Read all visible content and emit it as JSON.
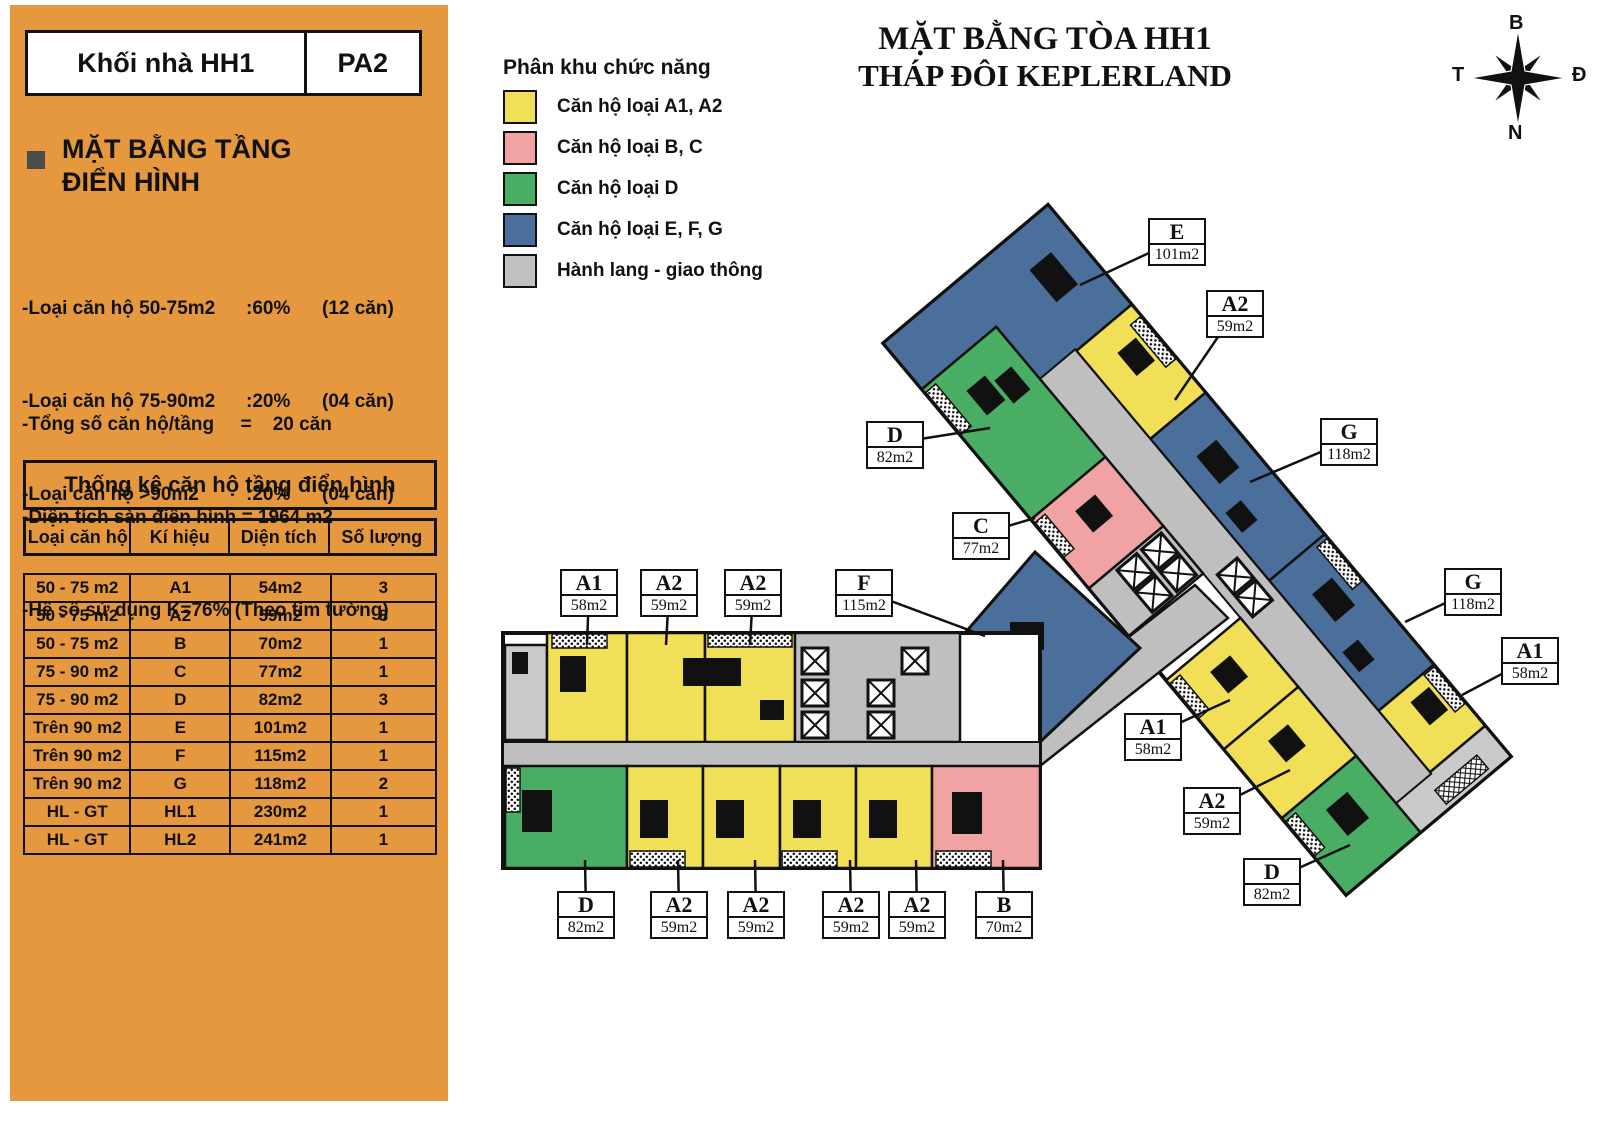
{
  "sidebar": {
    "header": {
      "left": "Khối nhà HH1",
      "right": "PA2"
    },
    "section_title_line1": "MẶT BẰNG TẦNG",
    "section_title_line2": "ĐIỂN HÌNH",
    "stats1": [
      {
        "label": "-Loại căn hộ 50-75m2",
        "pct": ":60%",
        "count": "(12 căn)"
      },
      {
        "label": "-Loại căn hộ 75-90m2",
        "pct": ":20%",
        "count": "(04 căn)"
      },
      {
        "label": "-Loại căn hộ >90m2",
        "pct": ":20%",
        "count": "(04 căn)"
      }
    ],
    "stats2": [
      "-Tổng số căn hộ/tầng     =    20 căn",
      "-Diện tích sàn điển hình = 1964 m2",
      "-Hệ số sử dụng K=76% (Theo tim tường)"
    ],
    "table": {
      "title": "Thống kê căn hộ tầng điển hình",
      "columns": [
        "Loại căn hộ",
        "Kí hiệu",
        "Diện tích",
        "Số lượng"
      ],
      "rows": [
        [
          "50 - 75 m2",
          "A1",
          "54m2",
          "3"
        ],
        [
          "50 - 75 m2",
          "A2",
          "59m2",
          "8"
        ],
        [
          "50 - 75 m2",
          "B",
          "70m2",
          "1"
        ],
        [
          "75 - 90 m2",
          "C",
          "77m2",
          "1"
        ],
        [
          "75 - 90 m2",
          "D",
          "82m2",
          "3"
        ],
        [
          "Trên 90 m2",
          "E",
          "101m2",
          "1"
        ],
        [
          "Trên 90 m2",
          "F",
          "115m2",
          "1"
        ],
        [
          "Trên 90 m2",
          "G",
          "118m2",
          "2"
        ],
        [
          "HL - GT",
          "HL1",
          "230m2",
          "1"
        ],
        [
          "HL - GT",
          "HL2",
          "241m2",
          "1"
        ]
      ]
    }
  },
  "legend": {
    "title": "Phân khu chức năng",
    "items": [
      {
        "label": "Căn hộ loại A1, A2",
        "color": "#F0DF57"
      },
      {
        "label": "Căn hộ loại B, C",
        "color": "#F1A2A2"
      },
      {
        "label": "Căn hộ loại D",
        "color": "#4AAD64"
      },
      {
        "label": "Căn hộ loại E, F, G",
        "color": "#4B6F9B"
      },
      {
        "label": "Hành lang - giao thông",
        "color": "#C1C1C1"
      }
    ]
  },
  "plan": {
    "title_line1": "MẶT BẰNG TÒA HH1",
    "title_line2": "THÁP ĐÔI KEPLERLAND",
    "compass": {
      "north": "B",
      "east": "Đ",
      "south": "N",
      "west": "T"
    },
    "labels": [
      {
        "code": "E",
        "area": "101m2",
        "x": 1148,
        "y": 218,
        "lx": 1080,
        "ly": 285
      },
      {
        "code": "A2",
        "area": "59m2",
        "x": 1206,
        "y": 290,
        "lx": 1175,
        "ly": 400
      },
      {
        "code": "G",
        "area": "118m2",
        "x": 1320,
        "y": 418,
        "lx": 1250,
        "ly": 482
      },
      {
        "code": "D",
        "area": "82m2",
        "x": 866,
        "y": 421,
        "lx": 990,
        "ly": 428
      },
      {
        "code": "C",
        "area": "77m2",
        "x": 952,
        "y": 512,
        "lx": 1035,
        "ly": 518
      },
      {
        "code": "F",
        "area": "115m2",
        "x": 835,
        "y": 569,
        "lx": 985,
        "ly": 636
      },
      {
        "code": "A1",
        "area": "58m2",
        "x": 560,
        "y": 569,
        "lx": 587,
        "ly": 645
      },
      {
        "code": "A2",
        "area": "59m2",
        "x": 640,
        "y": 569,
        "lx": 666,
        "ly": 645
      },
      {
        "code": "A2",
        "area": "59m2",
        "x": 724,
        "y": 569,
        "lx": 750,
        "ly": 645
      },
      {
        "code": "G",
        "area": "118m2",
        "x": 1444,
        "y": 568,
        "lx": 1405,
        "ly": 622
      },
      {
        "code": "A1",
        "area": "58m2",
        "x": 1501,
        "y": 637,
        "lx": 1462,
        "ly": 695
      },
      {
        "code": "A1",
        "area": "58m2",
        "x": 1124,
        "y": 713,
        "lx": 1230,
        "ly": 700
      },
      {
        "code": "A2",
        "area": "59m2",
        "x": 1183,
        "y": 787,
        "lx": 1290,
        "ly": 770
      },
      {
        "code": "D",
        "area": "82m2",
        "x": 1243,
        "y": 858,
        "lx": 1350,
        "ly": 845
      },
      {
        "code": "D",
        "area": "82m2",
        "x": 557,
        "y": 891,
        "lx": 585,
        "ly": 860
      },
      {
        "code": "A2",
        "area": "59m2",
        "x": 650,
        "y": 891,
        "lx": 678,
        "ly": 860
      },
      {
        "code": "A2",
        "area": "59m2",
        "x": 727,
        "y": 891,
        "lx": 755,
        "ly": 860
      },
      {
        "code": "A2",
        "area": "59m2",
        "x": 822,
        "y": 891,
        "lx": 850,
        "ly": 860
      },
      {
        "code": "A2",
        "area": "59m2",
        "x": 888,
        "y": 891,
        "lx": 916,
        "ly": 860
      },
      {
        "code": "B",
        "area": "70m2",
        "x": 975,
        "y": 891,
        "lx": 1003,
        "ly": 860
      }
    ]
  },
  "colors": {
    "sidebar_orange": "#E6983E",
    "unit_yellow": "#F0DF57",
    "unit_pink": "#F1A2A2",
    "unit_green": "#4AAD64",
    "unit_blue": "#4B6F9B",
    "corridor_gray": "#BFBFBF",
    "stair_gray": "#CACACA",
    "outline_black": "#111111"
  }
}
